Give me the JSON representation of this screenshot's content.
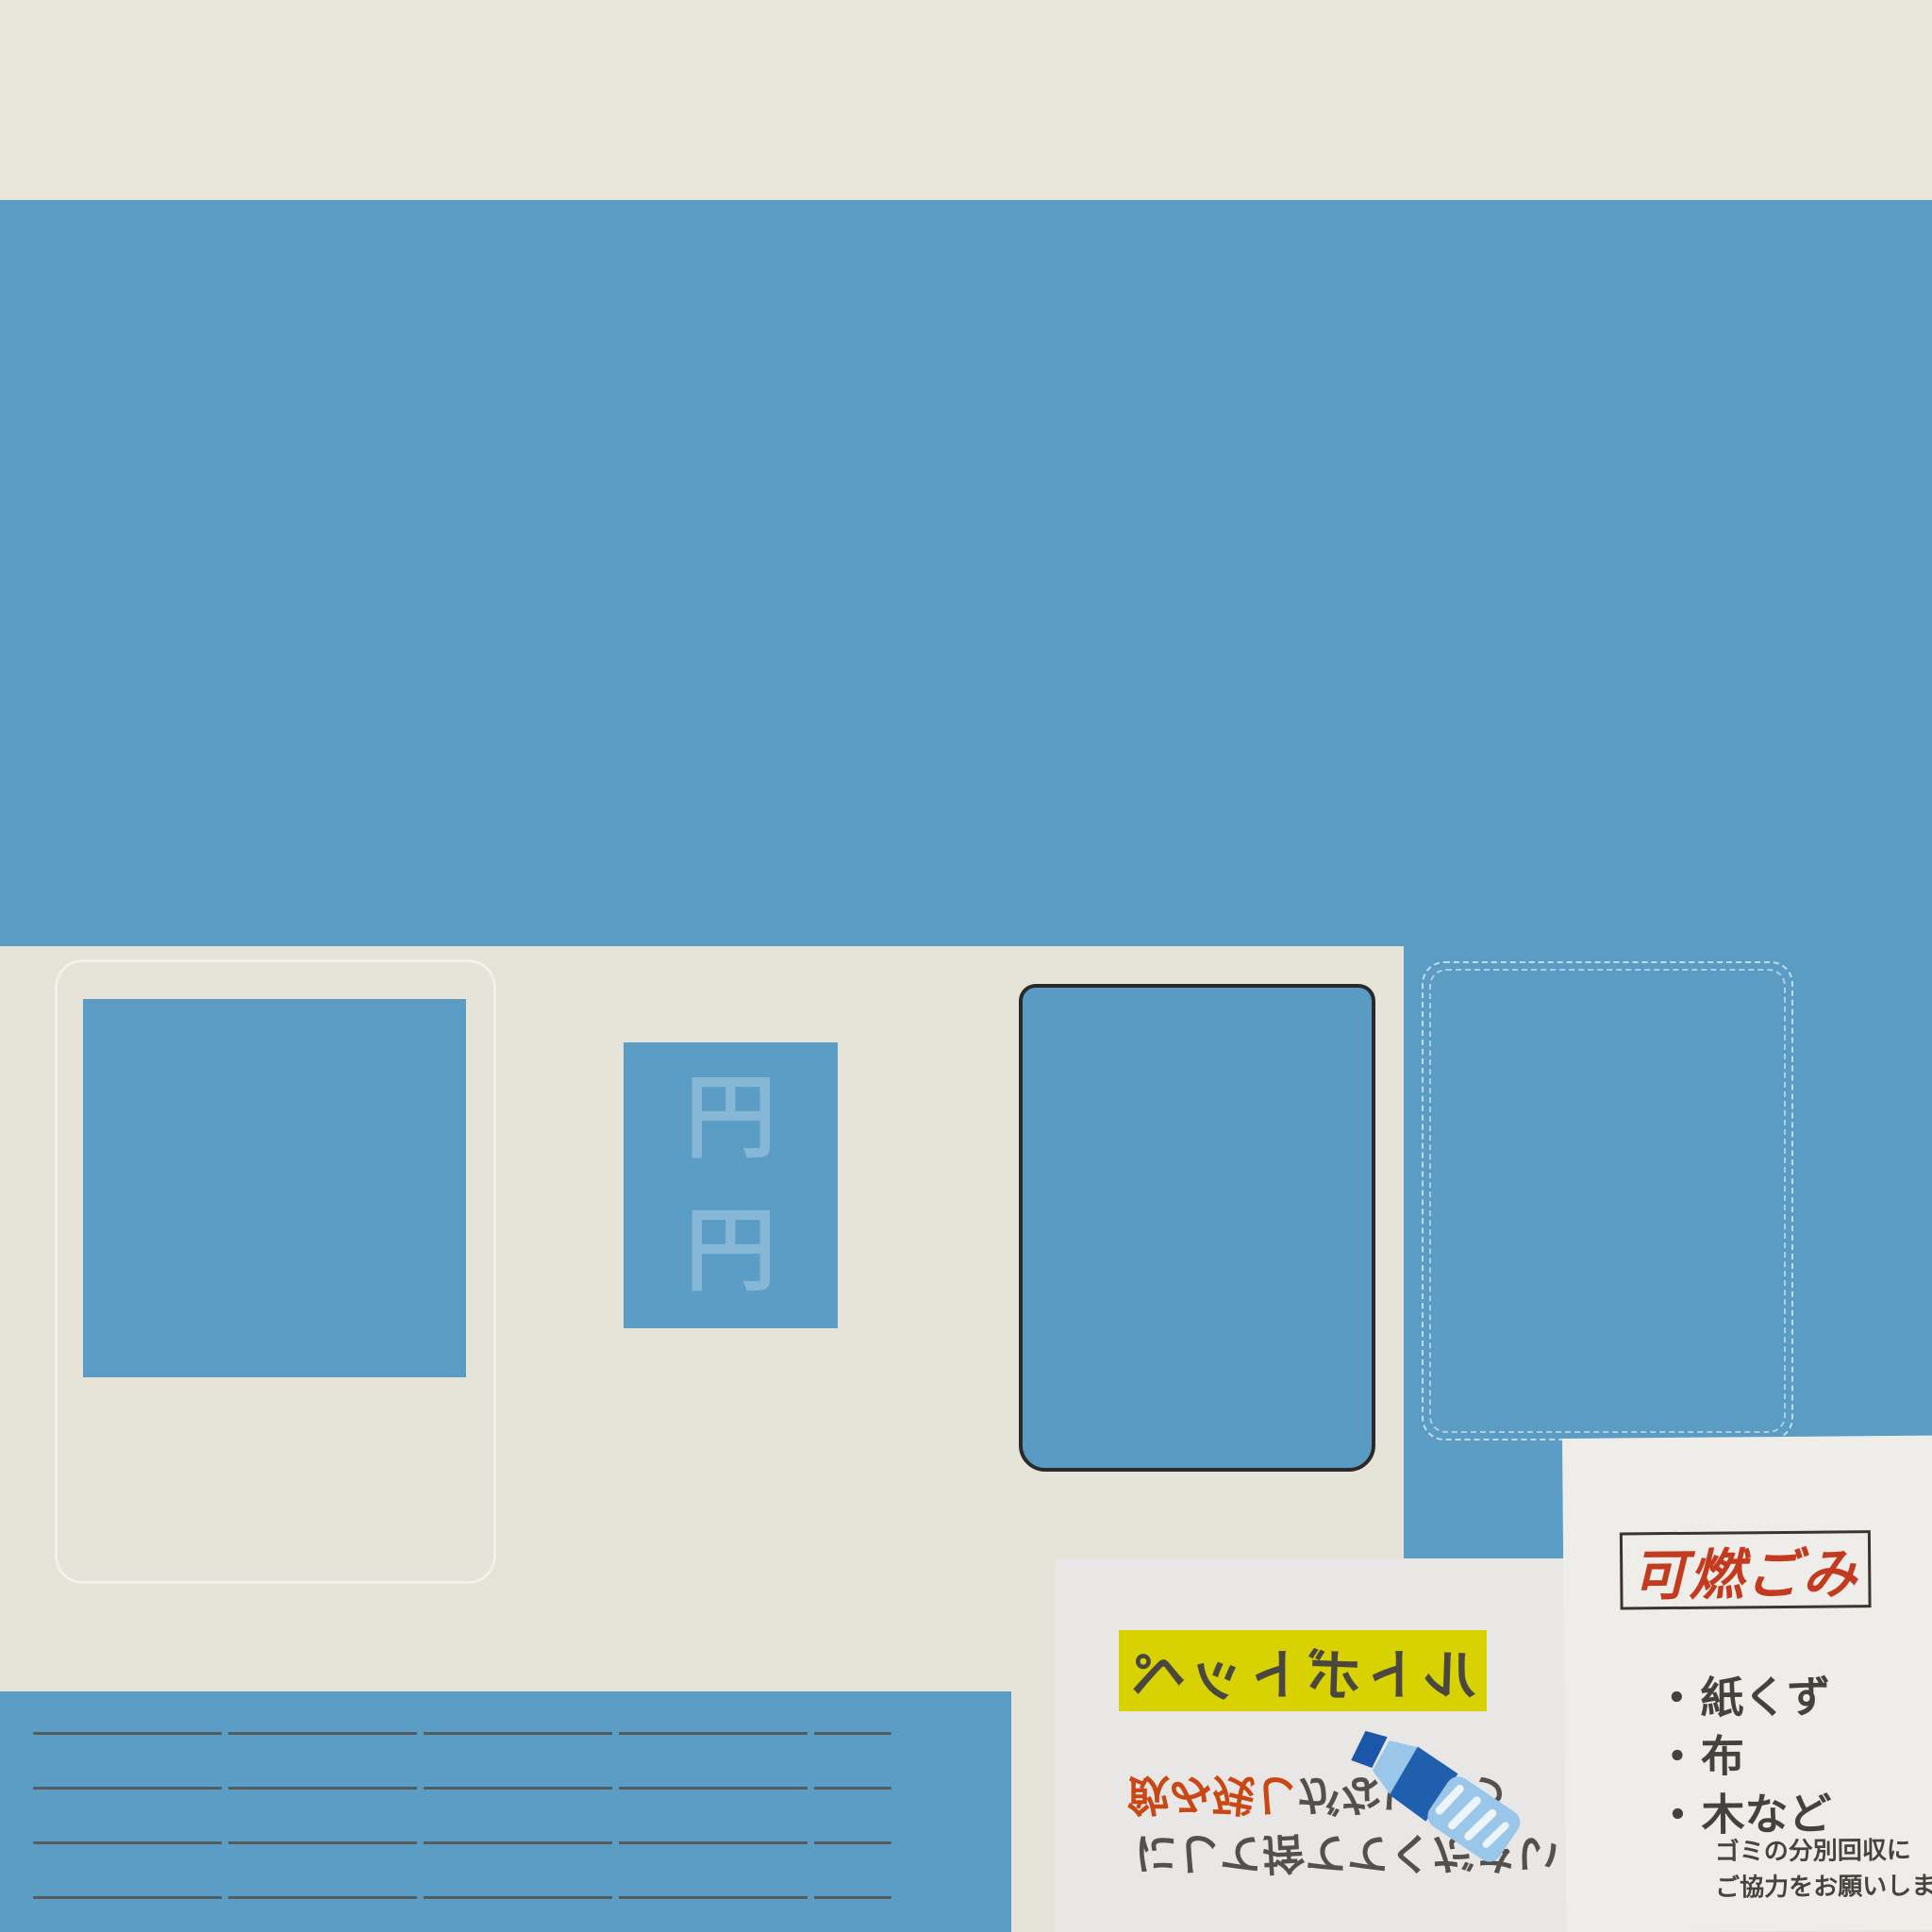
{
  "scene_title": "waste-collection texture sheet",
  "colors": {
    "background_cream": "#e6e3d9",
    "top_strip_cream": "#e9e6dc",
    "panel_blue": "#5b9cc5",
    "highlight_yellow": "#d8d202",
    "accent_red": "#c94715",
    "title_red": "#c33a1e",
    "text_dark_gray": "#4a4741",
    "pet_paper_white": "#e8e7e6",
    "burnable_paper_white": "#efedea"
  },
  "icons": {
    "pet_bottle": "pet-bottle-icon"
  },
  "price_panel": {
    "faint_glyph": "円"
  },
  "pet_notice": {
    "banner_title": "ペットボトル",
    "line1_accent": "飲み残し",
    "line1_rest": "がないよう",
    "line2": "にして捨ててください"
  },
  "burnable_notice": {
    "title": "可燃ごみ",
    "bullet": "・",
    "items": [
      "紙くず",
      "布",
      "木など"
    ],
    "footer_line1": "ゴミの分別回収に",
    "footer_line2": "ご協力をお願いします"
  }
}
